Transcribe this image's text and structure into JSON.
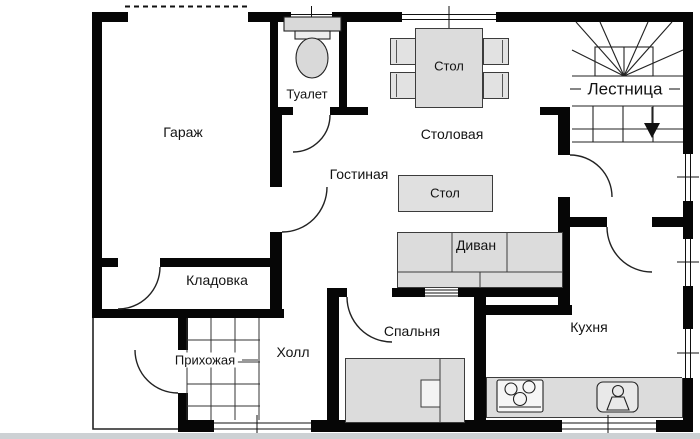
{
  "plan": {
    "title": "План этажа",
    "rooms": {
      "garage": "Гараж",
      "toilet": "Туалет",
      "dining_room": "Столовая",
      "living_room": "Гостиная",
      "stairs": "Лестница",
      "storage": "Кладовка",
      "entry_hall": "Прихожая",
      "hall": "Холл",
      "bedroom": "Спальня",
      "kitchen": "Кухня"
    },
    "furniture": {
      "dining_table": "Стол",
      "coffee_table": "Стол",
      "sofa": "Диван"
    },
    "colors": {
      "wall": "#060606",
      "furniture_fill": "#dcdcdc",
      "background": "#ffffff"
    }
  }
}
